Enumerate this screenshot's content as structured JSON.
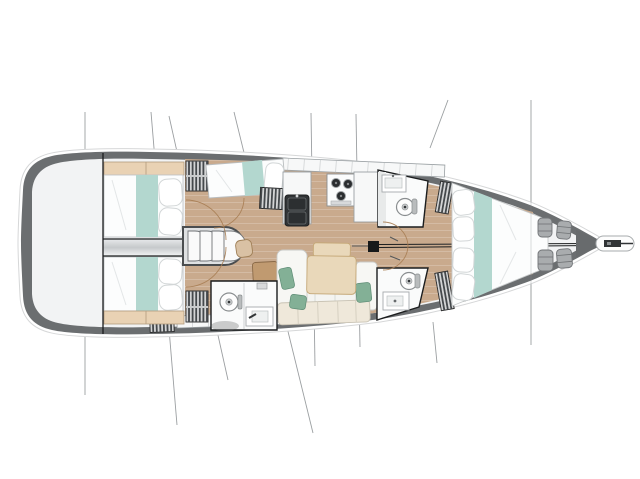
{
  "meta": {
    "description": "Sailing yacht interior layout plan, top view, bow pointing right",
    "diagram_type": "yacht-floorplan"
  },
  "colors": {
    "hull": "#6b6e70",
    "hullOutline": "#d6d7d8",
    "deck": "#f2f3f4",
    "wood": "#c9aa8d",
    "teal": "#b3d7cf",
    "bedWhite": "#fcfdfd",
    "furnitureWhite": "#f7f8f8",
    "tan": "#e9d2b4",
    "tableTan": "#e9d8ba",
    "cream": "#efe8da",
    "green": "#83b096",
    "seatBrown": "#c09a70",
    "darkFixture": "#313436",
    "graySeat": "#a9acae",
    "hatchBase": "#d3d4d5",
    "hatchBar": "#45494c",
    "outline": "#9aa0a3",
    "blackLine": "#1b1d1e",
    "rigLine": "#8a8e91",
    "doorArc": "#a87e54"
  },
  "plan": {
    "aft_cabins": [
      {
        "id": "port-aft-cabin",
        "bed": "double",
        "teal_runner": true
      },
      {
        "id": "starboard-aft-cabin",
        "bed": "double",
        "teal_runner": true
      }
    ],
    "mid_cabin": {
      "id": "port-mid-cabin",
      "bed": "angled-double",
      "teal_runner": true
    },
    "forward_cabin": {
      "id": "forward-owner-cabin",
      "bed": "v-berth",
      "teal_runner": true
    },
    "heads": [
      {
        "id": "starboard-aft-head",
        "toilet": true,
        "sink": true,
        "shower": true
      },
      {
        "id": "port-forward-head",
        "toilet": true,
        "sink": true
      },
      {
        "id": "starboard-forward-head",
        "toilet": true,
        "sink": true
      }
    ],
    "galley": {
      "burners": 3,
      "sinks": 2,
      "counters": 3
    },
    "salon": {
      "sofa": "L-shaped",
      "green_pillows": 3,
      "table_sections": 2,
      "chart_seat": 1
    },
    "companionway_steps": 4,
    "hanging_lockers": 7,
    "bow": {
      "gray_seats": 4,
      "bowsprit": true,
      "anchor_fitting": true
    },
    "rigging_lines": 9,
    "mast": 1
  }
}
